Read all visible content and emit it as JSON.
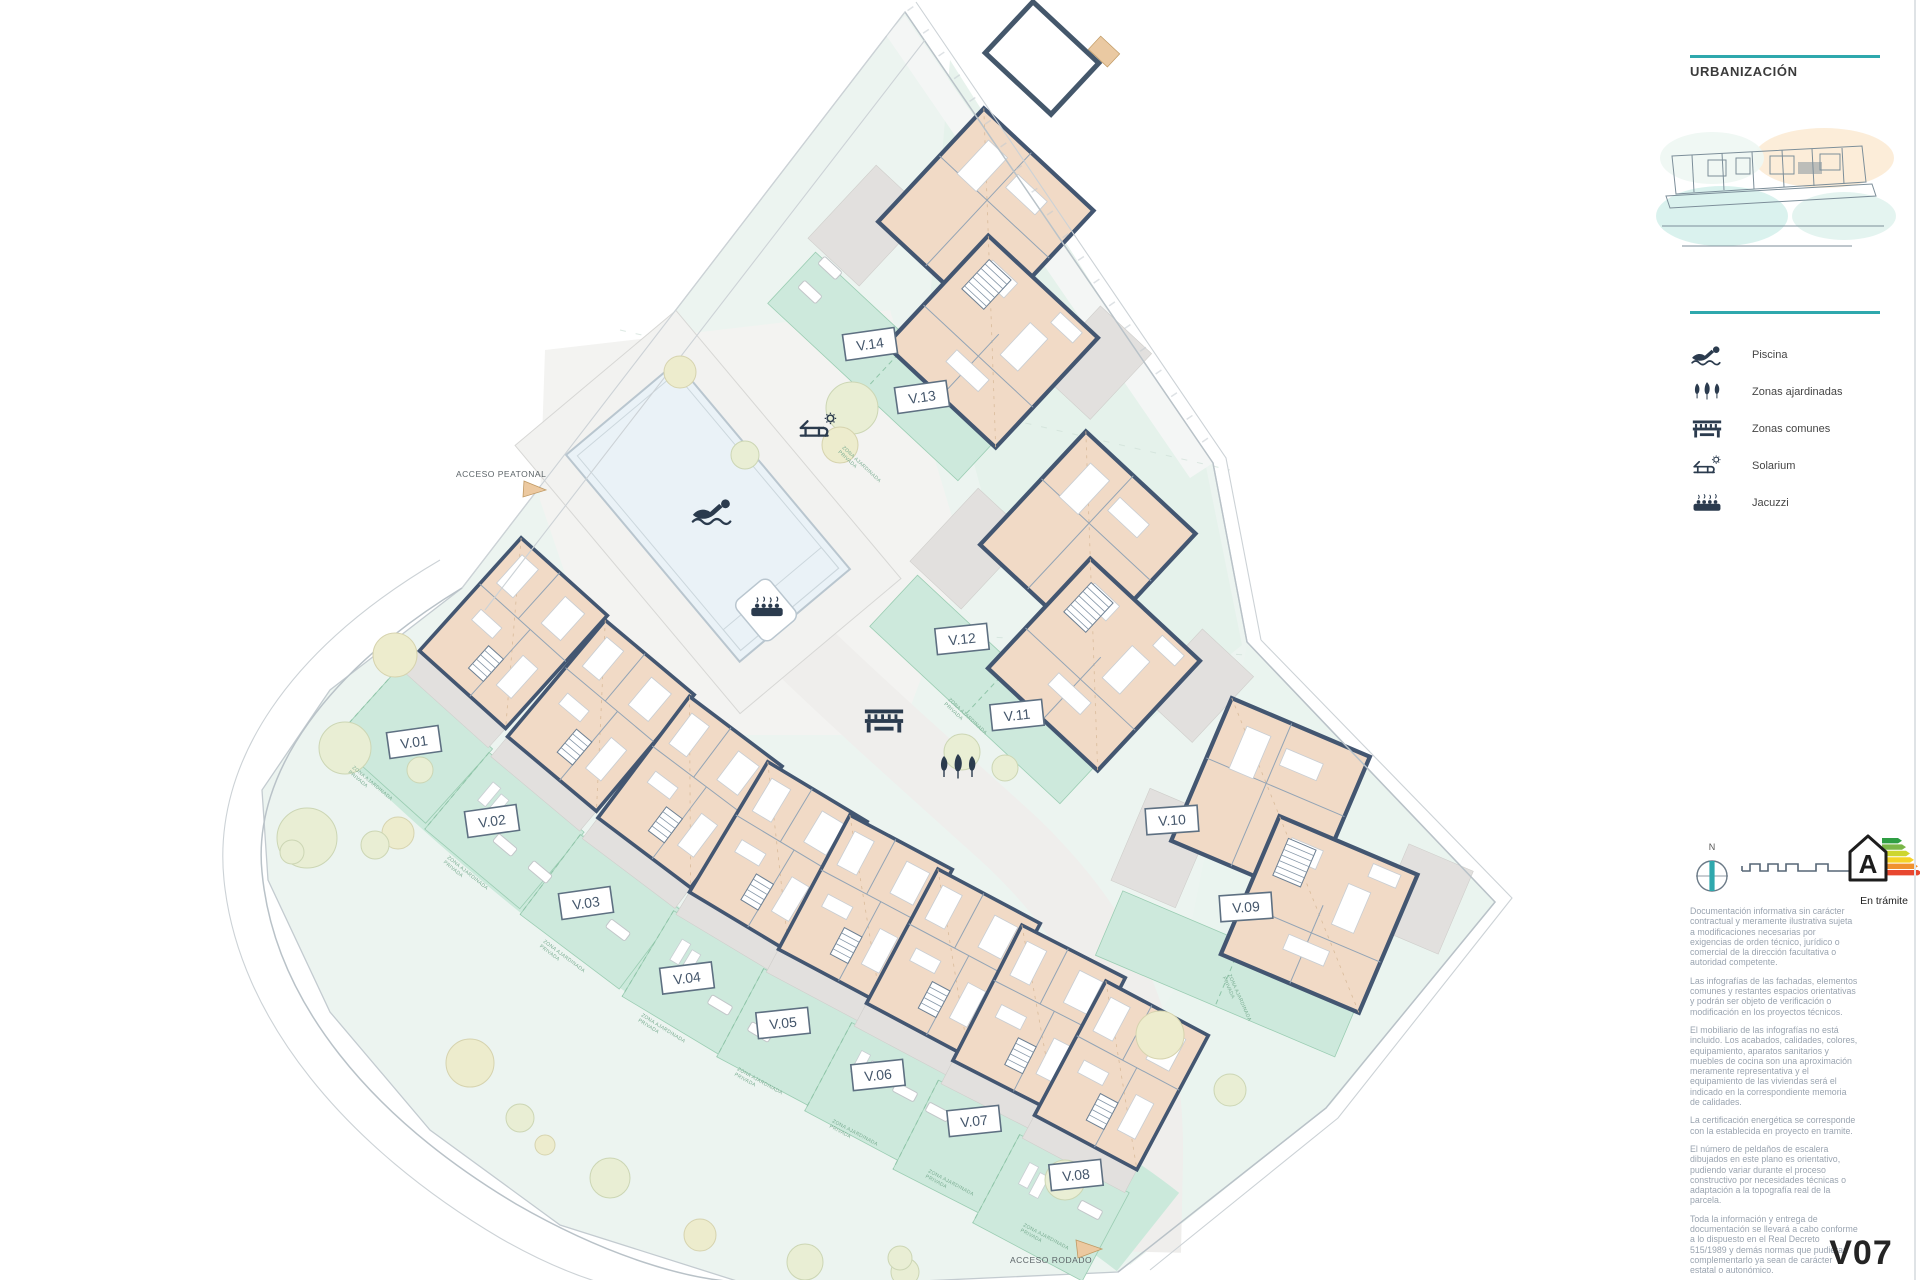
{
  "panel": {
    "title": "URBANIZACIÓN",
    "legend": [
      {
        "icon": "swimmer-icon",
        "label": "Piscina"
      },
      {
        "icon": "garden-trees-icon",
        "label": "Zonas ajardinadas"
      },
      {
        "icon": "bench-icon",
        "label": "Zonas comunes"
      },
      {
        "icon": "sun-lounger-icon",
        "label": "Solarium"
      },
      {
        "icon": "jacuzzi-icon",
        "label": "Jacuzzi"
      }
    ],
    "compass_north_label": "N",
    "energy": {
      "letter": "A",
      "status": "En trámite"
    },
    "disclaimer_paragraphs": [
      "Documentación informativa sin carácter contractual y meramente ilustrativa sujeta a modificaciones necesarias por exigencias de orden técnico, jurídico o comercial de la dirección facultativa o autoridad competente.",
      "Las infografías de las fachadas, elementos comunes y restantes espacios orientativas y podrán ser objeto de verificación o modificación en los proyectos técnicos.",
      "El mobiliario de las infografías no está incluido. Los acabados, calidades, colores, equipamiento, aparatos sanitarios y muebles de cocina son una aproximación meramente representativa y el equipamiento de las viviendas será el indicado en la correspondiente memoria de calidades.",
      "La certificación energética se corresponde con la establecida en proyecto en tramite.",
      "El número de peldaños de escalera dibujados en este plano es orientativo, pudiendo variar durante el proceso constructivo por necesidades técnicas o adaptación a la topografía real de la parcela.",
      "Toda la información y entrega de documentación se llevará a cabo conforme a lo dispuesto en el Real Decreto 515/1989 y demás normas que pudieran complementarlo ya sean de carácter estatal o autonómico."
    ],
    "sheet_code": "V07"
  },
  "plan": {
    "access_pedestrian_label": "ACCESO PEATONAL",
    "access_road_label": "ACCESO RODADO",
    "garden_strip_label": "ZONA AJARDINADA PRIVADA",
    "villas": [
      {
        "label": "V.01"
      },
      {
        "label": "V.02"
      },
      {
        "label": "V.03"
      },
      {
        "label": "V.04"
      },
      {
        "label": "V.05"
      },
      {
        "label": "V.06"
      },
      {
        "label": "V.07"
      },
      {
        "label": "V.08"
      },
      {
        "label": "V.09"
      },
      {
        "label": "V.10"
      },
      {
        "label": "V.11"
      },
      {
        "label": "V.12"
      },
      {
        "label": "V.13"
      },
      {
        "label": "V.14"
      }
    ]
  },
  "colors": {
    "accent_teal": "#2fa8ad",
    "wall_slate": "#435671",
    "room_tan": "#f1dac6",
    "garden_mint": "#cde9dc"
  }
}
